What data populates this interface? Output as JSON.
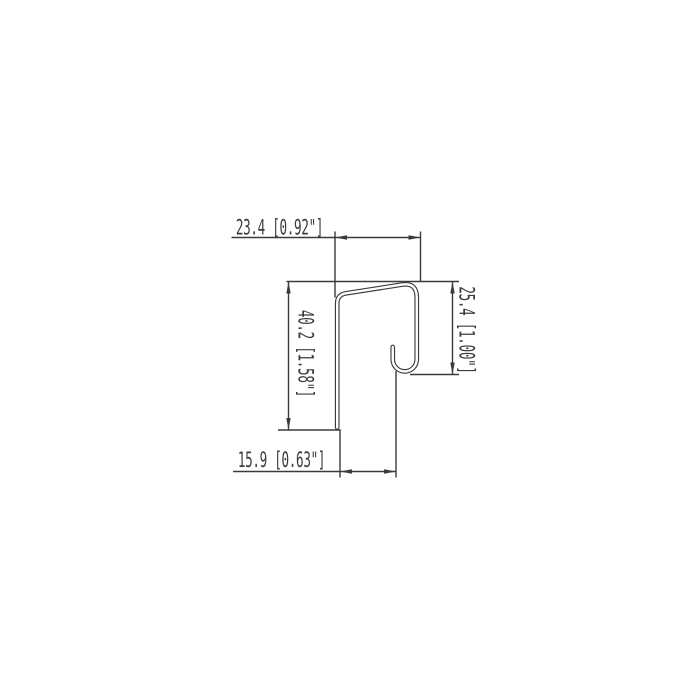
{
  "drawing": {
    "type": "technical-profile-cross-section",
    "background": "#ffffff",
    "line_color": "#3b3b3b",
    "dimensions": {
      "top": {
        "label": "23.4 [0.92\"]",
        "mm": 23.4,
        "inches": 0.92
      },
      "height_left": {
        "label": "40.2 [1.58\"]",
        "mm": 40.2,
        "inches": 1.58
      },
      "height_right": {
        "label": "25.4 [1.00\"]",
        "mm": 25.4,
        "inches": 1.0
      },
      "bottom": {
        "label": "15.9 [0.63\"]",
        "mm": 15.9,
        "inches": 0.63
      }
    }
  }
}
